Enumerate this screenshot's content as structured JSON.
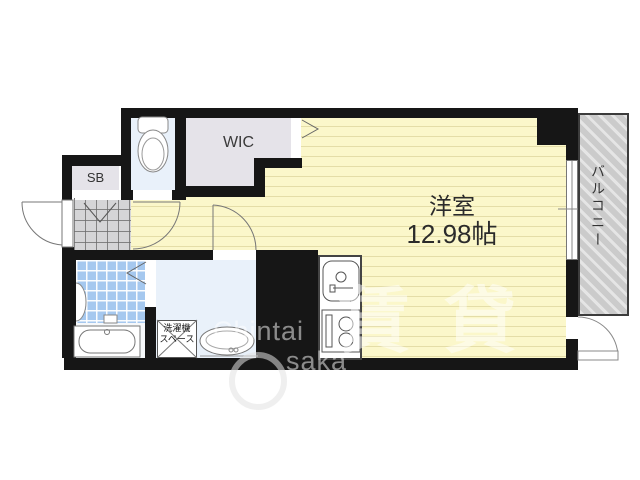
{
  "rooms": {
    "main": {
      "name": "洋室",
      "area": "12.98帖"
    },
    "wic": "WIC",
    "shoe_box": "SB",
    "balcony": "バルコニー",
    "laundry": [
      "洗濯機",
      "スペース"
    ]
  },
  "watermark": {
    "brand_top": "Chintai",
    "brand_bottom": "saka",
    "ghost": "賃貸"
  },
  "colors": {
    "wall": "#161616",
    "floor_yellow": "#FBF7CA",
    "floor_blue": "#E9F1FA",
    "floor_gray": "#E5E3E9",
    "tile_blue": "#A5C8EF",
    "genkan_gray": "#D5D5D7",
    "balcony_gray": "#CBCBCB"
  }
}
